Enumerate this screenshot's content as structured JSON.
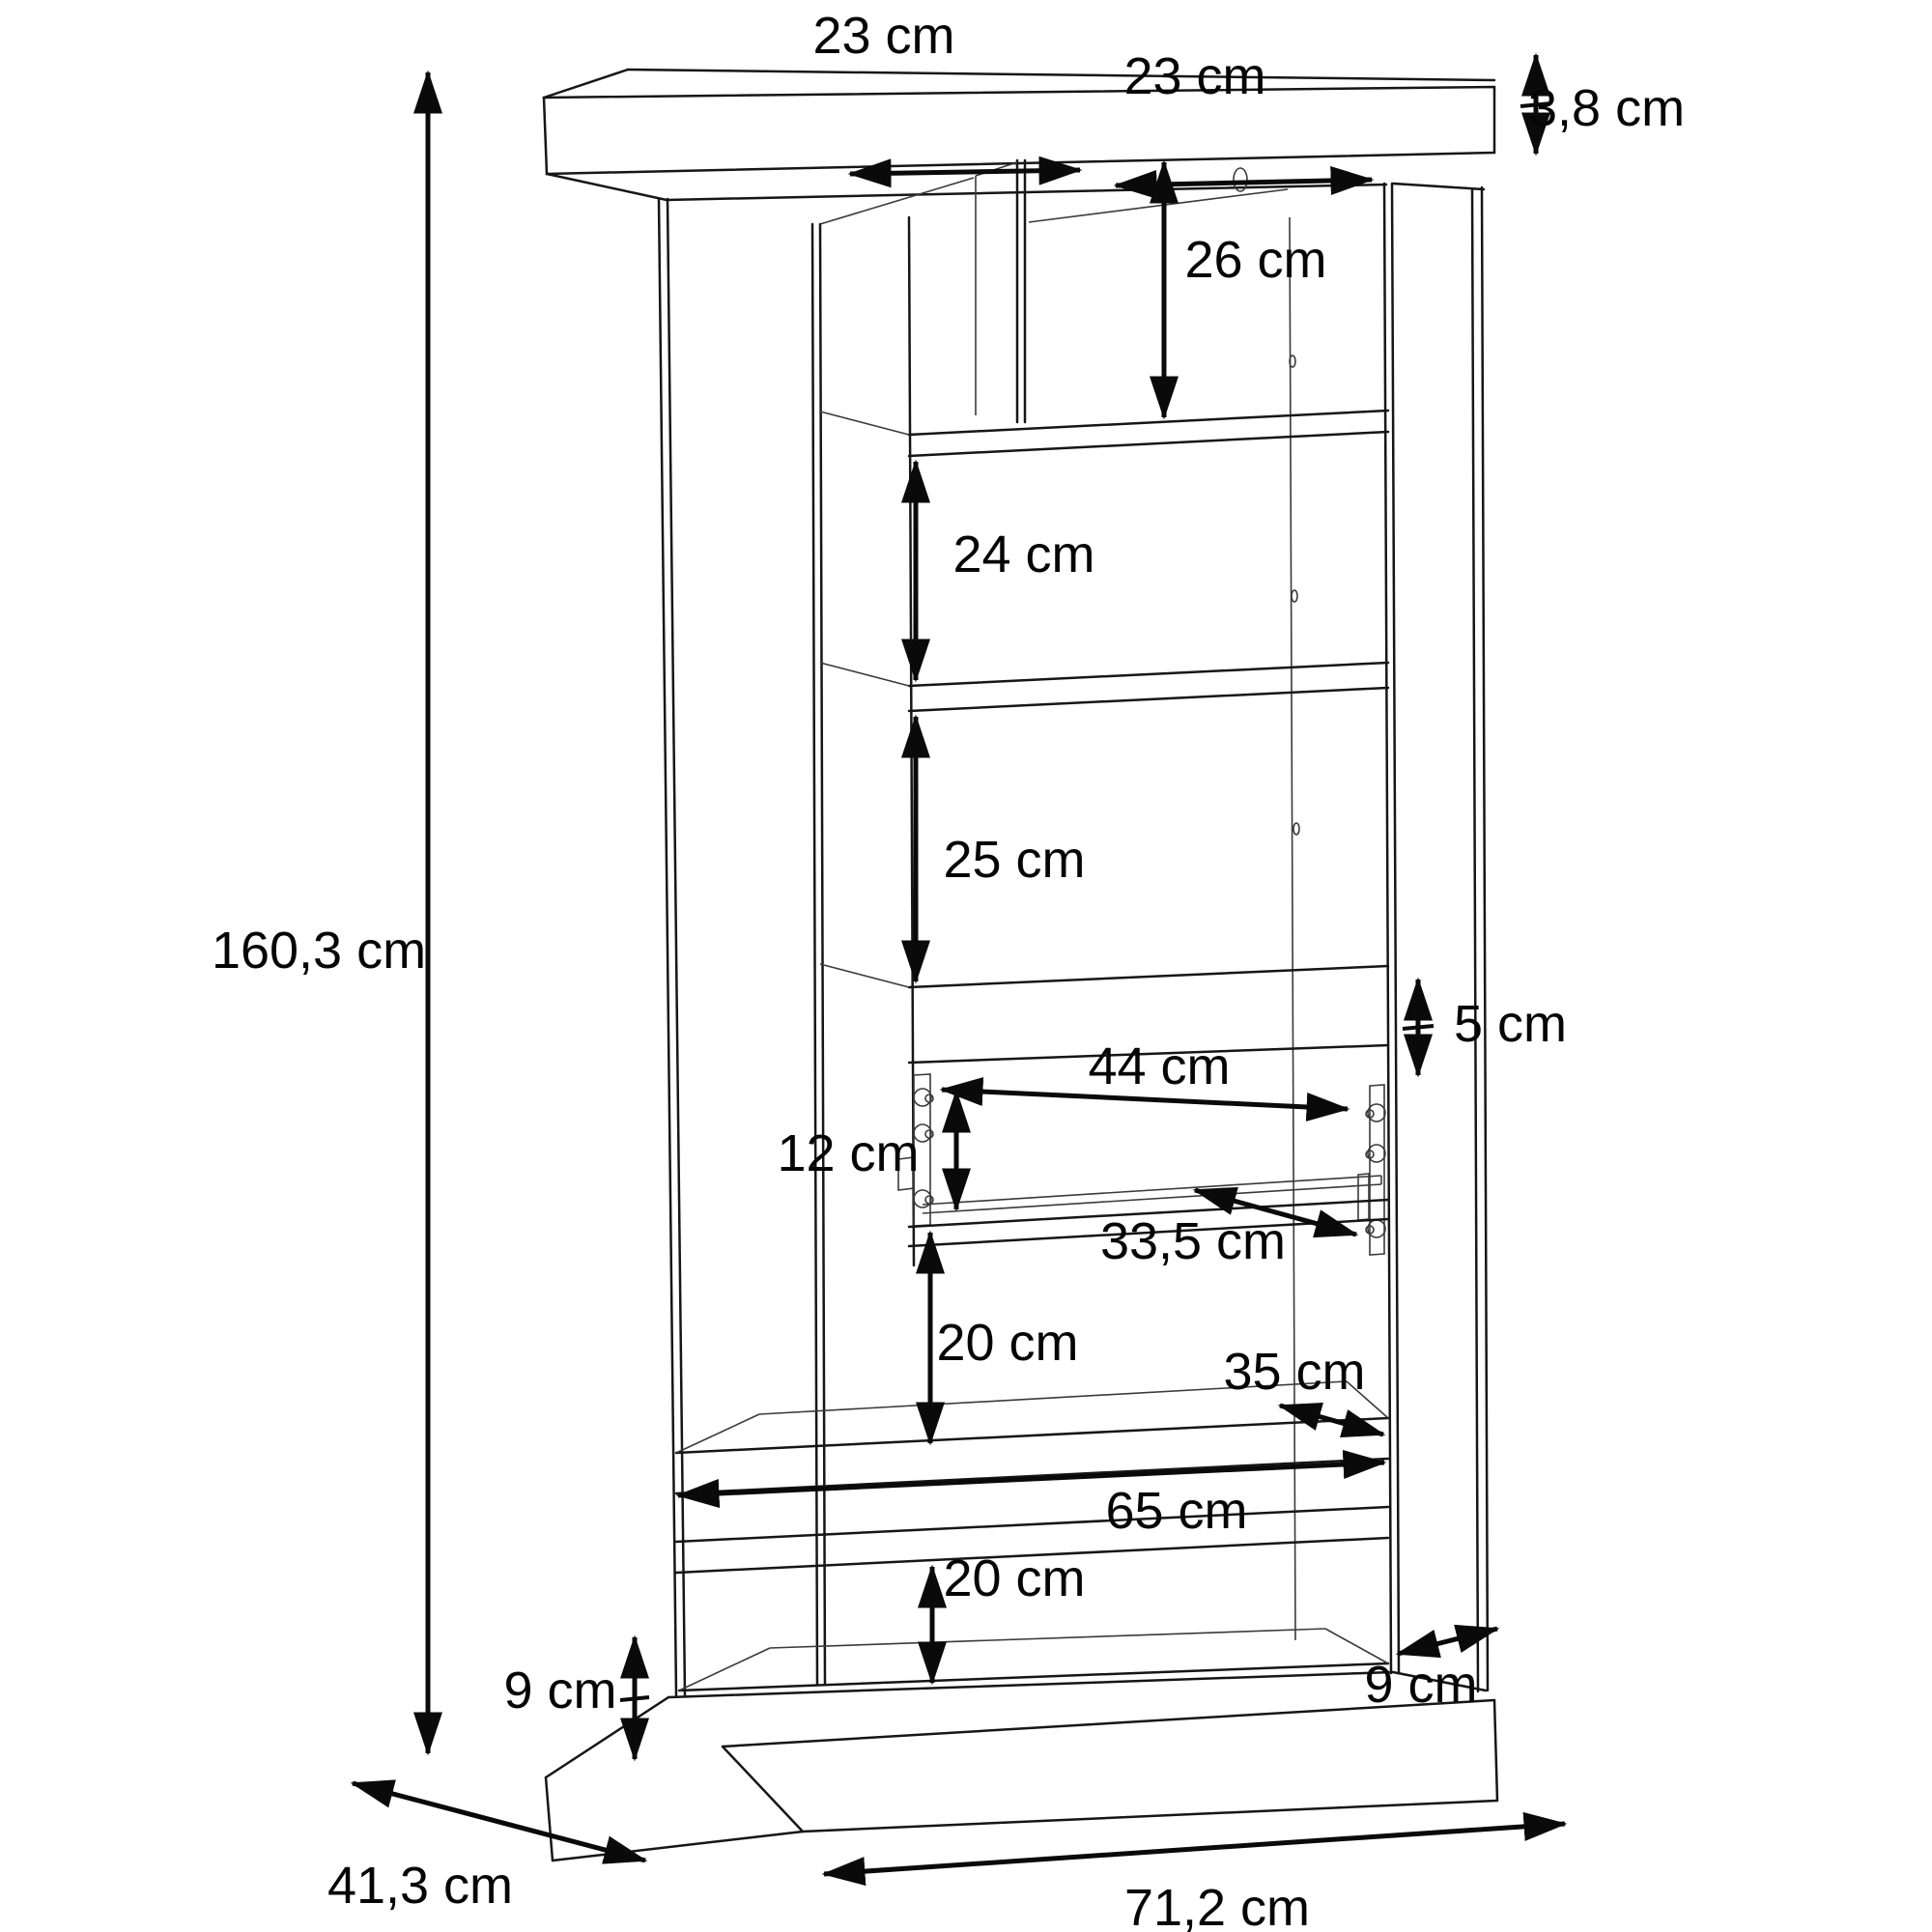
{
  "diagram": {
    "background_color": "#ffffff",
    "line_color": "#161616",
    "unit": "cm"
  },
  "dimensions": {
    "top_compartment_left_width": "23 cm",
    "top_compartment_right_width": "23 cm",
    "top_panel_thickness": "3,8 cm",
    "top_section_height": "26 cm",
    "upper_shelf_section_height": "24 cm",
    "middle_shelf_section_height": "25 cm",
    "overall_height": "160,3 cm",
    "apron_height": "5 cm",
    "drawer_inner_width": "44 cm",
    "drawer_front_height": "12 cm",
    "drawer_inner_depth": "33,5 cm",
    "upper_open_section_height": "20 cm",
    "shelf_depth": "35 cm",
    "bottom_inner_width": "65 cm",
    "lower_open_section_height": "20 cm",
    "plinth_height": "9 cm",
    "plinth_side_depth": "9 cm",
    "overall_depth": "41,3 cm",
    "overall_width": "71,2 cm"
  }
}
